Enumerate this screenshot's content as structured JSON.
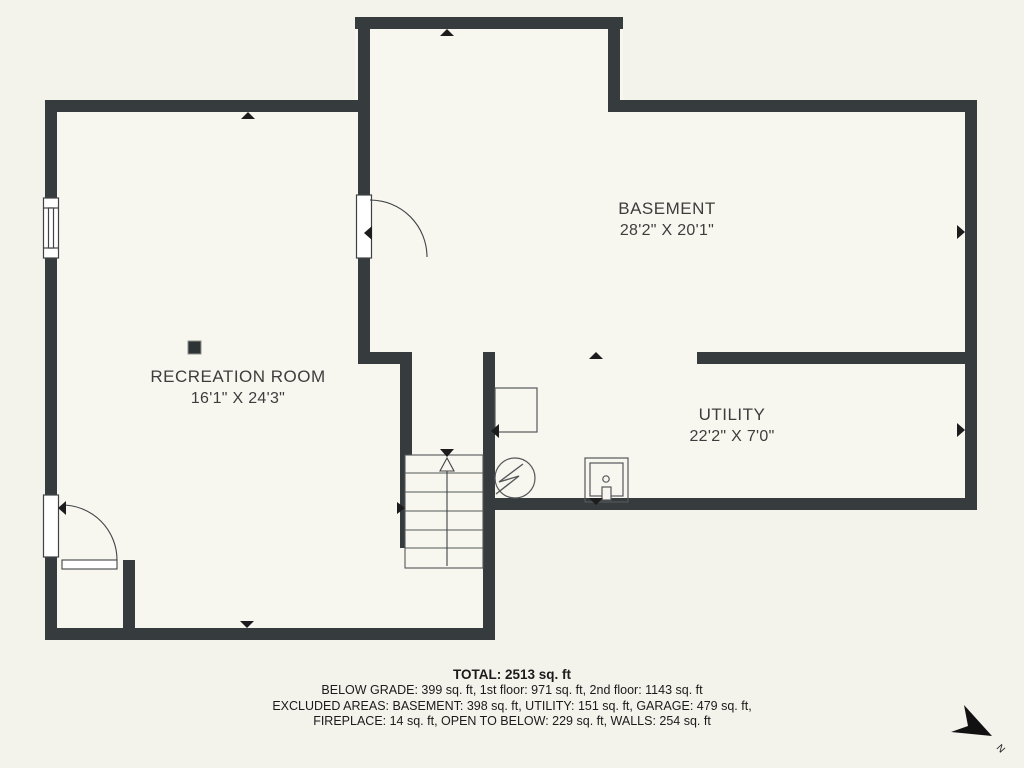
{
  "title": "Basement floor plan",
  "rooms": [
    {
      "name": "BASEMENT",
      "dimensions": "28'2\" X 20'1\""
    },
    {
      "name": "RECREATION ROOM",
      "dimensions": "16'1\" X 24'3\""
    },
    {
      "name": "UTILITY",
      "dimensions": "22'2\" X 7'0\""
    }
  ],
  "summary": {
    "total": "TOTAL: 2513 sq. ft",
    "line1": "BELOW GRADE: 399 sq. ft, 1st floor: 971 sq. ft, 2nd floor: 1143 sq. ft",
    "line2": "EXCLUDED AREAS: BASEMENT: 398 sq. ft, UTILITY: 151 sq. ft, GARAGE: 479 sq. ft,",
    "line3": "FIREPLACE: 14 sq. ft, OPEN TO BELOW: 229 sq. ft, WALLS: 254 sq. ft"
  },
  "compass": {
    "label": "N"
  },
  "colors": {
    "wall": "#363b3e",
    "room_fill": "#f8f7ef",
    "background": "#f3f2eb",
    "label_text": "#3d3d3d",
    "summary_text": "#1b1b1b"
  }
}
